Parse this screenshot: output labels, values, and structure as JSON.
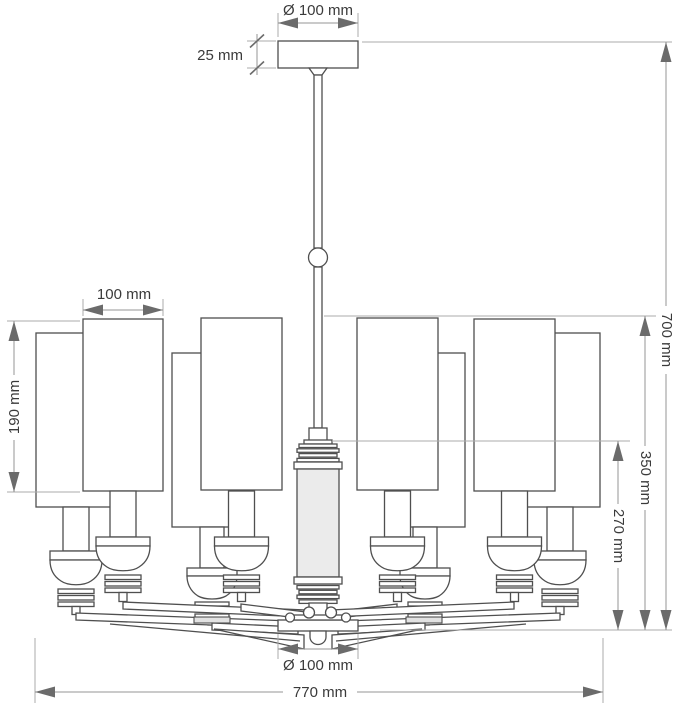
{
  "page": {
    "background": "#ffffff",
    "subject": "Technical dimension drawing of an eight-light chandelier with cylindrical shades, front elevation"
  },
  "drawing": {
    "units": "mm",
    "shade_count": 8,
    "arm_count": 8,
    "dimensions": {
      "canopy_diameter": "Ø 100 mm",
      "canopy_height": "25 mm",
      "shade_width": "100 mm",
      "shade_height": "190 mm",
      "total_height": "700 mm",
      "shade_top_to_bottom": "350 mm",
      "column_top_to_bottom": "270 mm",
      "hub_diameter": "Ø 100 mm",
      "total_width": "770 mm"
    },
    "colors": {
      "outline": "#4f4f4f",
      "dimension_line": "#969696",
      "arrowhead": "#6b6b6b",
      "text": "#3a3a3a",
      "column_fill": "#ebebeb",
      "background": "#ffffff"
    }
  }
}
